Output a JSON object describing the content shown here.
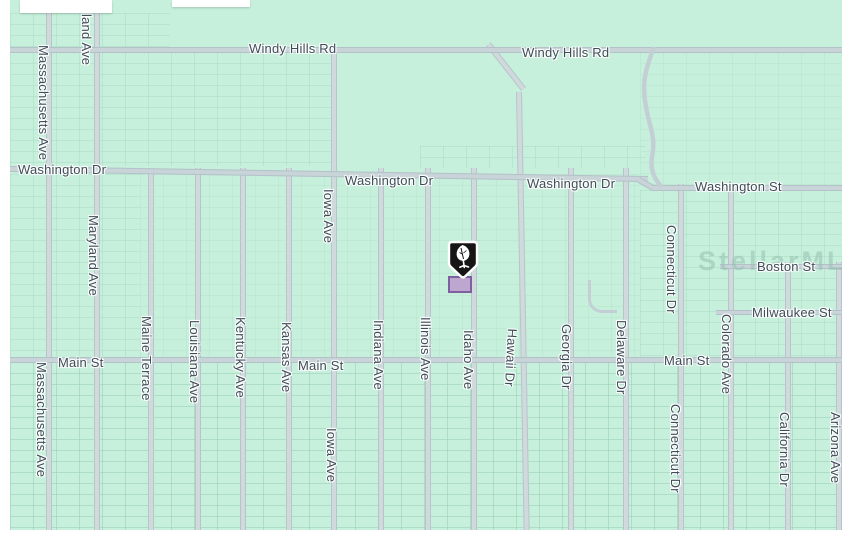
{
  "map": {
    "watermark": "StellarMLS",
    "colors": {
      "background": "#c6f0db",
      "road_fill": "#d0dadd",
      "road_edge": "#b7c5cb",
      "label_text": "#3f4d58",
      "parcel_line": "#92c7b1",
      "marker_pin_fill": "#161616",
      "marker_pin_border": "#ffffff",
      "parcel_highlight_fill": "#bda6cf",
      "parcel_highlight_border": "#7e5fa0"
    },
    "marker": {
      "icon": "tree-icon",
      "type": "property-location-pin"
    },
    "street_labels": [
      {
        "text": "Windy Hills Rd"
      },
      {
        "text": "Windy Hills Rd"
      },
      {
        "text": "Washington Dr"
      },
      {
        "text": "Washington Dr"
      },
      {
        "text": "Washington Dr"
      },
      {
        "text": "Washington St"
      },
      {
        "text": "Boston St"
      },
      {
        "text": "Milwaukee St"
      },
      {
        "text": "Main St"
      },
      {
        "text": "Main St"
      },
      {
        "text": "Main St"
      },
      {
        "text": "Massachusetts Ave"
      },
      {
        "text": "land Ave"
      },
      {
        "text": "Maryland Ave"
      },
      {
        "text": "Iowa Ave"
      },
      {
        "text": "Connecticut Dr"
      },
      {
        "text": "Massachusetts Ave"
      },
      {
        "text": "Maine Terrace"
      },
      {
        "text": "Louisiana Ave"
      },
      {
        "text": "Kentucky Ave"
      },
      {
        "text": "Kansas Ave"
      },
      {
        "text": "Iowa Ave"
      },
      {
        "text": "Indiana Ave"
      },
      {
        "text": "Illinois Ave"
      },
      {
        "text": "Idaho Ave"
      },
      {
        "text": "Hawaii Dr"
      },
      {
        "text": "Georgia Dr"
      },
      {
        "text": "Delaware Dr"
      },
      {
        "text": "Connecticut Dr"
      },
      {
        "text": "Colorado Ave"
      },
      {
        "text": "California Dr"
      },
      {
        "text": "Arizona Ave"
      }
    ]
  }
}
